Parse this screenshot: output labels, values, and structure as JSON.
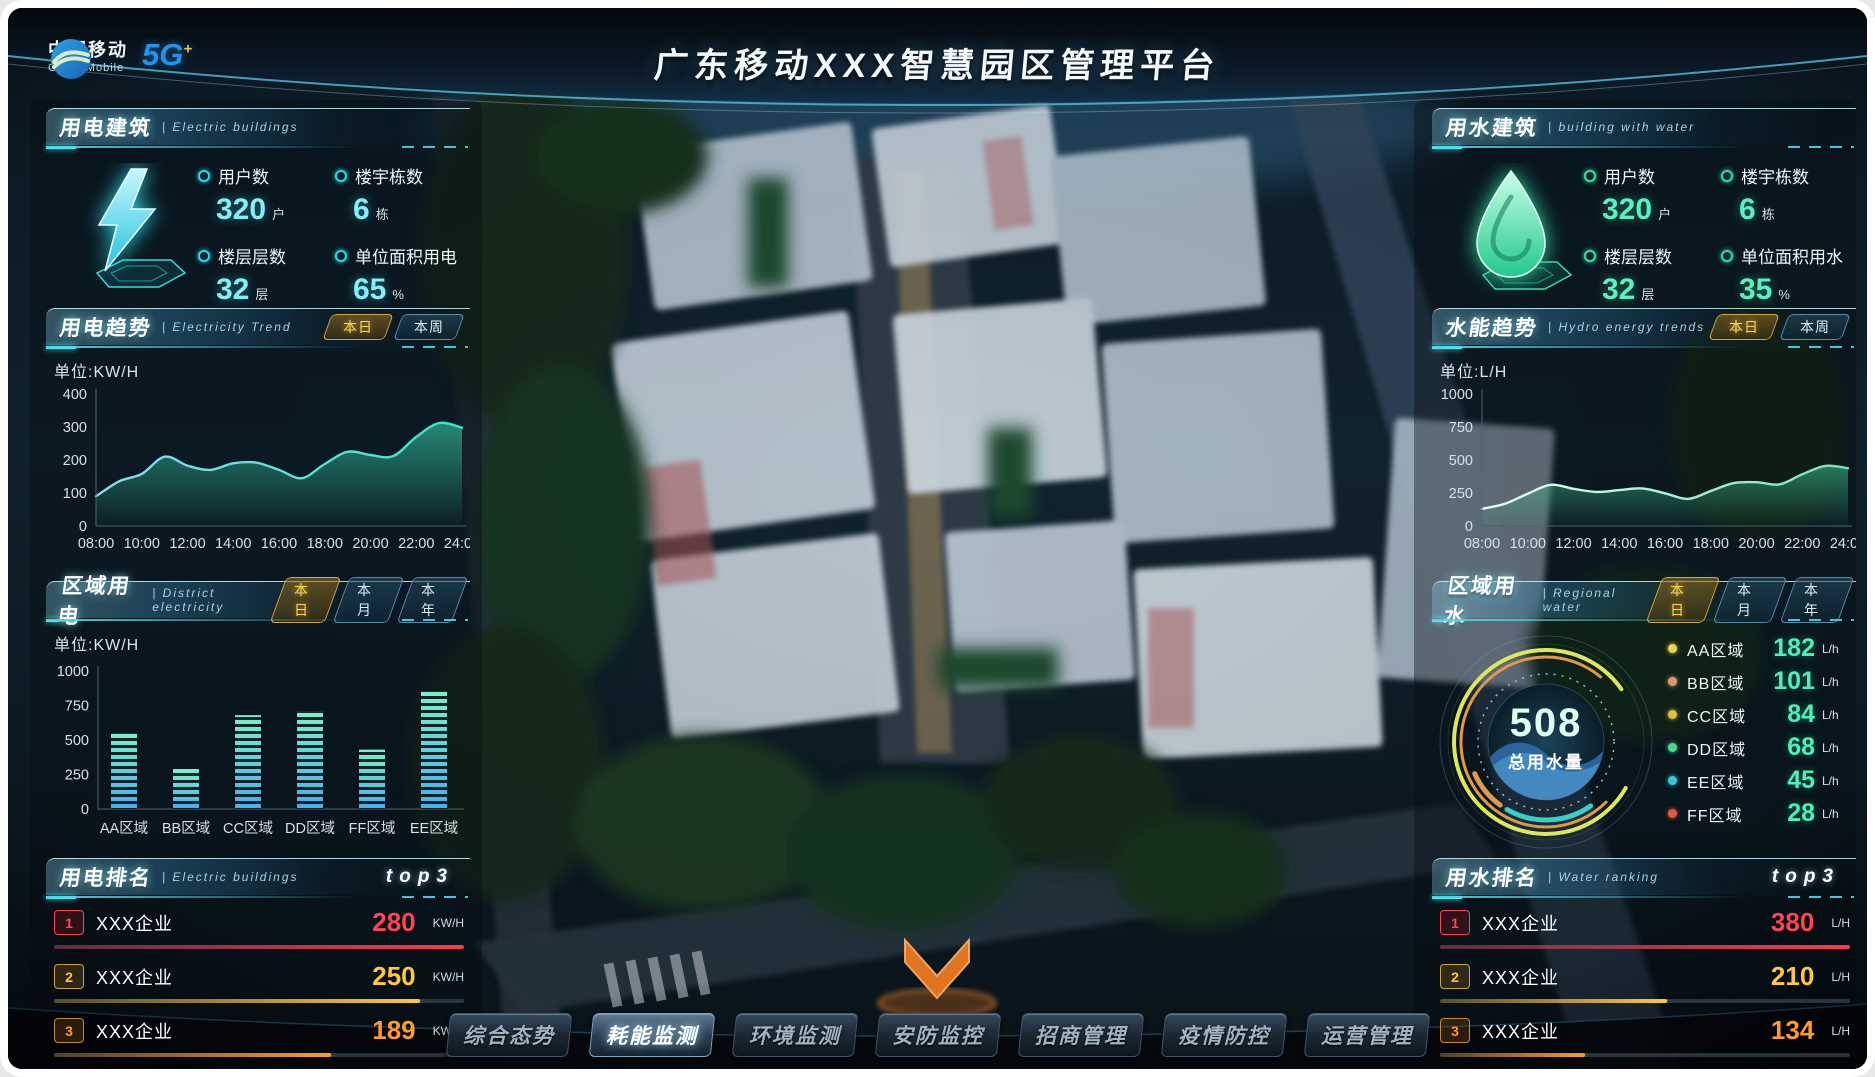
{
  "header": {
    "title": "广东移动XXX智慧园区管理平台",
    "logo": {
      "cn": "中国移动",
      "en": "China Mobile",
      "badge": "5G",
      "badge_sup": "+"
    }
  },
  "colors": {
    "accent_cyan": "#35d0e0",
    "accent_green": "#2fe0a0",
    "tab_active_gold": "#ffd956",
    "rank1": "#ff4455",
    "rank2": "#ffc83c",
    "rank3": "#ff9a2e",
    "value_mint": "#4df0b8"
  },
  "panels": {
    "electric_buildings": {
      "title": "用电建筑",
      "subtitle": "| Electric buildings",
      "stats": [
        {
          "label": "用户数",
          "value": "320",
          "unit": "户"
        },
        {
          "label": "楼宇栋数",
          "value": "6",
          "unit": "栋"
        },
        {
          "label": "楼层层数",
          "value": "32",
          "unit": "层"
        },
        {
          "label": "单位面积用电",
          "value": "65",
          "unit": "%"
        }
      ]
    },
    "electricity_trend": {
      "title": "用电趋势",
      "subtitle": "| Electricity Trend",
      "tabs": [
        "本日",
        "本周"
      ],
      "active_tab": "本日",
      "unit_label": "单位:KW/H"
    },
    "district_electricity": {
      "title": "区域用电",
      "subtitle": "| District electricity",
      "tabs": [
        "本日",
        "本月",
        "本年"
      ],
      "active_tab": "本日",
      "unit_label": "单位:KW/H"
    },
    "electric_ranking": {
      "title": "用电排名",
      "subtitle": "| Electric buildings",
      "top_label": "top3",
      "rows": [
        {
          "rank": "1",
          "name": "XXX企业",
          "value": "280",
          "unit": "KW/H"
        },
        {
          "rank": "2",
          "name": "XXX企业",
          "value": "250",
          "unit": "KW/H"
        },
        {
          "rank": "3",
          "name": "XXX企业",
          "value": "189",
          "unit": "KW/H"
        }
      ]
    },
    "water_buildings": {
      "title": "用水建筑",
      "subtitle": "| building with water",
      "stats": [
        {
          "label": "用户数",
          "value": "320",
          "unit": "户"
        },
        {
          "label": "楼宇栋数",
          "value": "6",
          "unit": "栋"
        },
        {
          "label": "楼层层数",
          "value": "32",
          "unit": "层"
        },
        {
          "label": "单位面积用水",
          "value": "35",
          "unit": "%"
        }
      ]
    },
    "hydro_trend": {
      "title": "水能趋势",
      "subtitle": "| Hydro energy trends",
      "tabs": [
        "本日",
        "本周"
      ],
      "active_tab": "本日",
      "unit_label": "单位:L/H"
    },
    "regional_water": {
      "title": "区域用水",
      "subtitle": "| Regional water",
      "tabs": [
        "本日",
        "本月",
        "本年"
      ],
      "active_tab": "本日",
      "gauge_value": "508",
      "gauge_label": "总用水量",
      "legend_unit": "L/h"
    },
    "water_ranking": {
      "title": "用水排名",
      "subtitle": "| Water ranking",
      "top_label": "top3",
      "rows": [
        {
          "rank": "1",
          "name": "XXX企业",
          "value": "380",
          "unit": "L/H"
        },
        {
          "rank": "2",
          "name": "XXX企业",
          "value": "210",
          "unit": "L/H"
        },
        {
          "rank": "3",
          "name": "XXX企业",
          "value": "134",
          "unit": "L/H"
        }
      ]
    }
  },
  "nav": {
    "items": [
      "综合态势",
      "耗能监测",
      "环境监测",
      "安防监控",
      "招商管理",
      "疫情防控",
      "运营管理"
    ],
    "active": "耗能监测"
  },
  "chart_data": [
    {
      "id": "electricity_trend",
      "type": "area",
      "title": "用电趋势(本日)",
      "ylabel": "单位:KW/H",
      "x_labels": [
        "08:00",
        "10:00",
        "12:00",
        "14:00",
        "16:00",
        "18:00",
        "20:00",
        "22:00",
        "24:00"
      ],
      "values": [
        90,
        135,
        158,
        210,
        183,
        170,
        190,
        192,
        170,
        145,
        188,
        225,
        215,
        212,
        270,
        312,
        298
      ],
      "ylim": [
        0,
        400
      ],
      "yticks": [
        0,
        100,
        200,
        300,
        400
      ],
      "line_color_from": "#8fd8f4",
      "line_color_to": "#35e8c2",
      "fill_color": "#3ae2b8"
    },
    {
      "id": "hydro_trend",
      "type": "area",
      "title": "水能趋势(本日)",
      "ylabel": "单位:L/H",
      "x_labels": [
        "08:00",
        "10:00",
        "12:00",
        "14:00",
        "16:00",
        "18:00",
        "20:00",
        "22:00",
        "24:00"
      ],
      "values": [
        130,
        168,
        245,
        312,
        282,
        258,
        272,
        285,
        248,
        205,
        265,
        325,
        332,
        315,
        392,
        455,
        438
      ],
      "ylim": [
        0,
        1000
      ],
      "yticks": [
        0,
        250,
        500,
        750,
        1000
      ],
      "line_color_from": "#eafff6",
      "line_color_to": "#6fe8b8",
      "fill_color": "#3fc88f"
    },
    {
      "id": "district_electricity",
      "type": "bar",
      "title": "区域用电(本日)",
      "ylabel": "单位:KW/H",
      "categories": [
        "AA区域",
        "BB区域",
        "CC区域",
        "DD区域",
        "FF区域",
        "EE区域"
      ],
      "values": [
        550,
        290,
        680,
        710,
        430,
        850
      ],
      "ylim": [
        0,
        1000
      ],
      "yticks": [
        0,
        250,
        500,
        750,
        1000
      ],
      "bar_color_top": "#7df0c8",
      "bar_color_bottom": "#4aaee8"
    },
    {
      "id": "regional_water",
      "type": "donut",
      "title": "区域用水(本日)",
      "center_value": 508,
      "center_label": "总用水量",
      "segments": [
        {
          "name": "AA区域",
          "value": 182,
          "color": "#e8d44d"
        },
        {
          "name": "BB区域",
          "value": 101,
          "color": "#d89a6a"
        },
        {
          "name": "CC区域",
          "value": 84,
          "color": "#e0c040"
        },
        {
          "name": "DD区域",
          "value": 68,
          "color": "#4fd88a"
        },
        {
          "name": "EE区域",
          "value": 45,
          "color": "#38c8d8"
        },
        {
          "name": "FF区域",
          "value": 28,
          "color": "#e05848"
        }
      ]
    }
  ]
}
